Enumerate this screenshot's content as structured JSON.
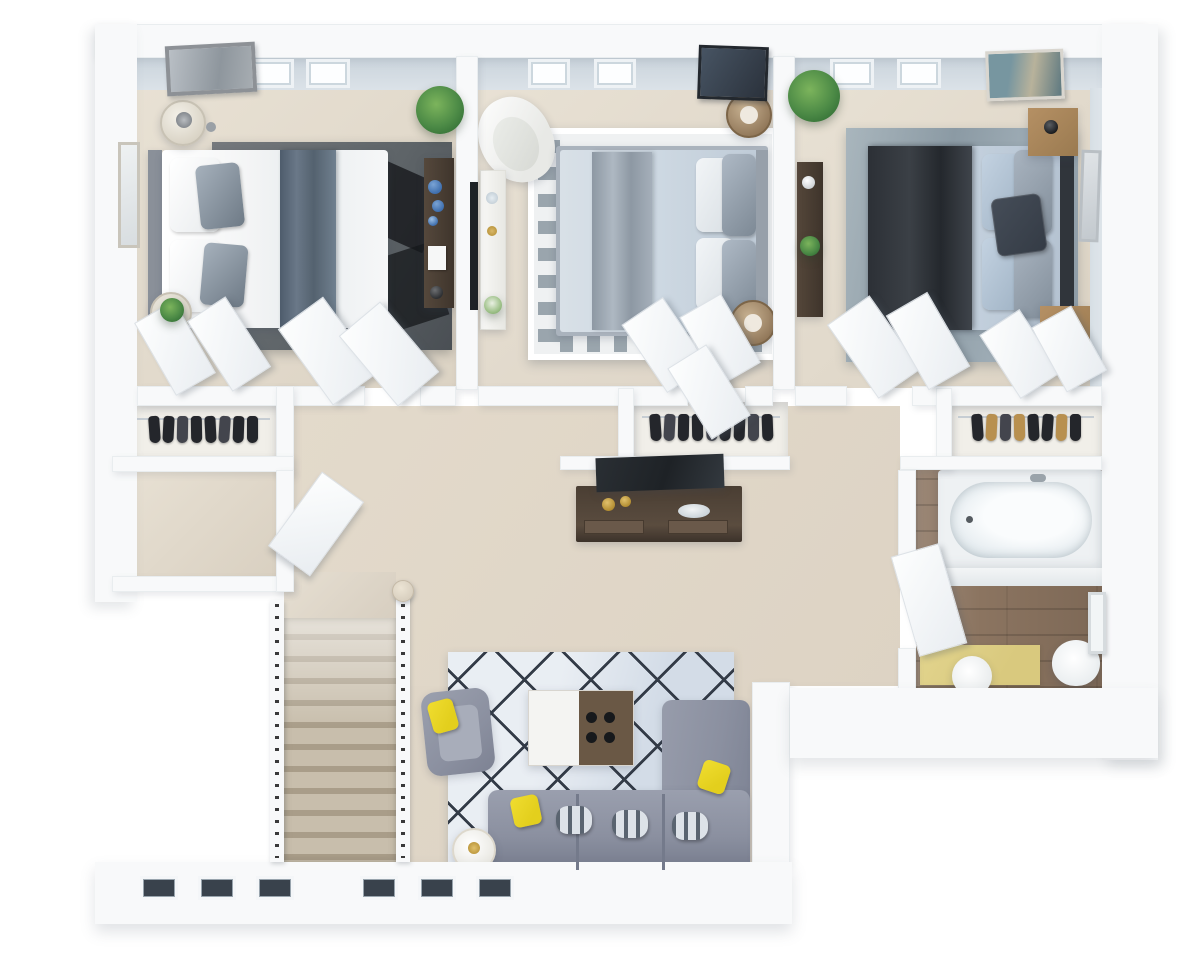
{
  "scene": {
    "type": "3d-floor-plan-render",
    "view": "top-down-axonometric",
    "text_visible": "none",
    "rooms": [
      {
        "name": "bedroom-left",
        "flooring": "beige carpet",
        "furniture": [
          "double bed with white duvet and slate velvet runner",
          "dark grey area rug with black geometric pattern",
          "round glass bedside table with lamp",
          "round bedside table with plant",
          "dark wood dresser with blue vases",
          "framed wall art",
          "tall wall mirror",
          "potted plant",
          "two windows"
        ]
      },
      {
        "name": "bedroom-middle",
        "flooring": "beige carpet",
        "furniture": [
          "double bed with pale blue duvet and silver runner",
          "white rug with grey greek-key border",
          "white curved lounge chair",
          "white sideboard with decor",
          "wall-mounted tv",
          "two rattan drum side tables",
          "dark abstract wall art",
          "two windows"
        ]
      },
      {
        "name": "bedroom-right",
        "flooring": "beige carpet",
        "furniture": [
          "double bed with charcoal throw and blue-grey pillows",
          "textured blue-grey rug",
          "two wooden nightstands with black lamps",
          "dark wood desk console",
          "teal abstract wall art",
          "framed art on side wall",
          "potted plant",
          "two windows"
        ]
      },
      {
        "name": "walk-in-closet-left",
        "furniture": [
          "clothes rail with hanging garments",
          "bi-fold doors ajar"
        ]
      },
      {
        "name": "walk-in-closet-middle",
        "furniture": [
          "clothes rail with hanging garments",
          "bi-fold doors ajar"
        ]
      },
      {
        "name": "walk-in-closet-right",
        "furniture": [
          "clothes rail with hanging garments",
          "bi-fold doors ajar"
        ]
      },
      {
        "name": "hallway",
        "furniture": [
          "dark wood media console",
          "leaning flat-screen tv",
          "gold vases",
          "decor bowl"
        ]
      },
      {
        "name": "storage-room",
        "furniture": [
          "open door"
        ]
      },
      {
        "name": "bathroom",
        "flooring": "wood planks",
        "furniture": [
          "built-in bathtub",
          "round toilet",
          "yellow bath mat",
          "white round stool",
          "wall cabinet mirror",
          "open door"
        ]
      },
      {
        "name": "staircase",
        "furniture": [
          "wood treads",
          "white railings with dark balusters",
          "round newel post"
        ]
      },
      {
        "name": "living-area",
        "flooring": "beige carpet",
        "furniture": [
          "l-shaped grey sofa",
          "yellow accent pillows",
          "patterned scatter pillows",
          "grey armchair with yellow pillow",
          "two-tone coffee table with black knobs",
          "round white side table",
          "light blue rug with dark diamond lattice",
          "three windows on lower wall"
        ]
      },
      {
        "name": "open-void",
        "furniture": []
      }
    ]
  },
  "closets": {
    "left": {
      "garments": [
        "dark",
        "dark",
        "slate",
        "dark",
        "dark",
        "slate",
        "dark",
        "dark"
      ]
    },
    "middle": {
      "garments": [
        "dark",
        "slate",
        "dark",
        "dark",
        "slate",
        "dark",
        "dark",
        "slate",
        "dark"
      ]
    },
    "right": {
      "garments": [
        "dark",
        "tan",
        "slate",
        "tan",
        "dark",
        "dark",
        "tan",
        "dark"
      ]
    }
  },
  "colors": {
    "wall": "#f8f9fa",
    "wall_face": "#c9d3db",
    "carpet": "#ddd3c4",
    "carpet_light": "#e8e1d4",
    "closet_floor": "#f1efe9",
    "wood": "#8b7460",
    "rug_dark_a": "#75797d",
    "rug_dark_b": "#4a4f54",
    "rug_patch": "#16181b",
    "rug_key_bg": "#eff1f2",
    "rug_key_line": "#9aa5ad",
    "rug_tex_a": "#a9b6bd",
    "rug_tex_b": "#8b9aa4",
    "rug_living": "#d3dce7",
    "rug_living_line": "#333b47",
    "duvet_white": "#f3f4f5",
    "runner_slate_a": "#4e5c6c",
    "runner_slate_b": "#6a7888",
    "duvet_blue": "#cdd8e2",
    "runner_silver_a": "#8d98a3",
    "runner_silver_b": "#aeb8c2",
    "duvet_pale": "#c2cfdc",
    "throw_a": "#2c3036",
    "throw_b": "#3f444b",
    "pillow_gray": "#93a0ac",
    "sofa_gray": "#8b90a0",
    "sofa_dark": "#747a8b",
    "pillow_yellow": "#e3cf1d",
    "table_wood": "#6a5845",
    "table_white": "#f4f4f2",
    "knob_black": "#17191c",
    "console_dark": "#4a3e33",
    "console_dark2": "#5a4c3f",
    "tv_black": "#1e2226",
    "stair_tread": "#c8beac",
    "stair_shadow": "#a99d89",
    "rail_wood": "#d9d0c0",
    "baluster": "#3a3a3a",
    "plant_light": "#7cb45c",
    "plant_green": "#4c8a46",
    "plant_dark": "#2f6b33",
    "brass": "#b08a2e",
    "blue_decor": "#3f6fae",
    "tub_deck": "#eef1f3",
    "tub_white": "#fafcfd",
    "tub_inner": "#e4ebef",
    "mat_yellow": "#d9c97e",
    "drum_a": "#c7b191",
    "drum_b": "#8e7456",
    "nstand_wood_a": "#b59064",
    "nstand_wood_b": "#9a7a50",
    "garment_dark": "#24262b",
    "garment_slate": "#43454d",
    "garment_tan": "#b8904f"
  }
}
